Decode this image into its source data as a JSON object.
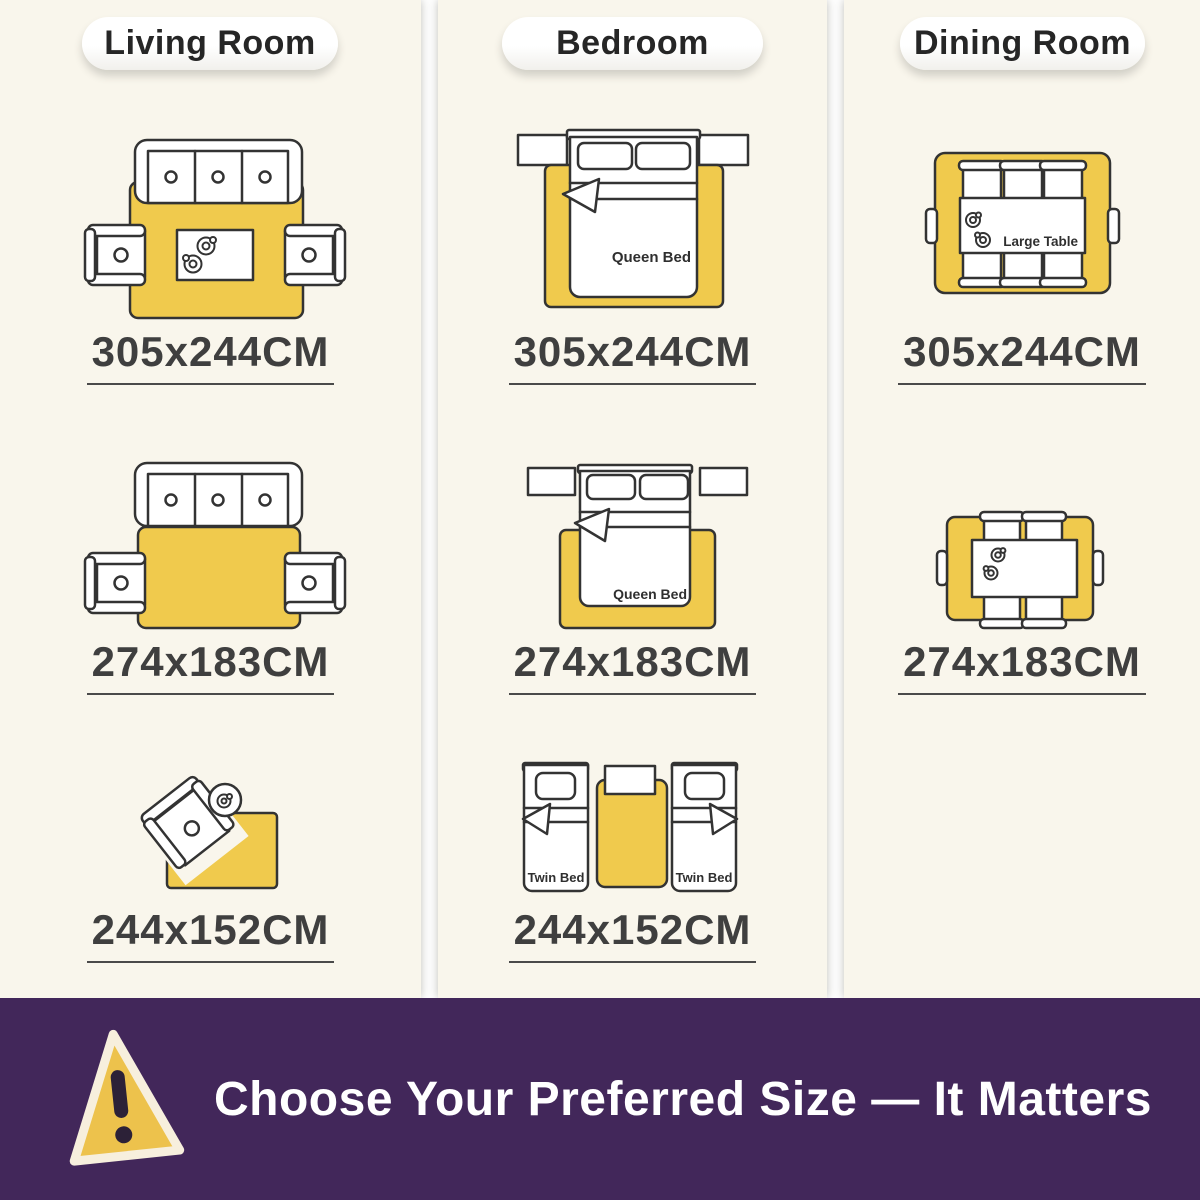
{
  "columns": [
    {
      "title": "Living Room",
      "sizes": [
        "305x244CM",
        "274x183CM",
        "244x152CM"
      ]
    },
    {
      "title": "Bedroom",
      "queen_bed_label": "Queen Bed",
      "twin_bed_label": "Twin Bed",
      "sizes": [
        "305x244CM",
        "274x183CM",
        "244x152CM"
      ]
    },
    {
      "title": "Dining Room",
      "table_label": "Large Table",
      "sizes": [
        "305x244CM",
        "274x183CM"
      ]
    }
  ],
  "banner": {
    "text": "Choose Your Preferred Size — It Matters",
    "icon": "warning-triangle"
  },
  "colors": {
    "panel_background": "#f9f6ec",
    "rug_yellow": "#f0ca4d",
    "outline": "#333333",
    "banner_purple": "#42275a",
    "label_text": "#3f3f3f",
    "banner_text": "#ffffff",
    "warning_fill": "#edc24c",
    "warning_mark": "#2c2137"
  }
}
